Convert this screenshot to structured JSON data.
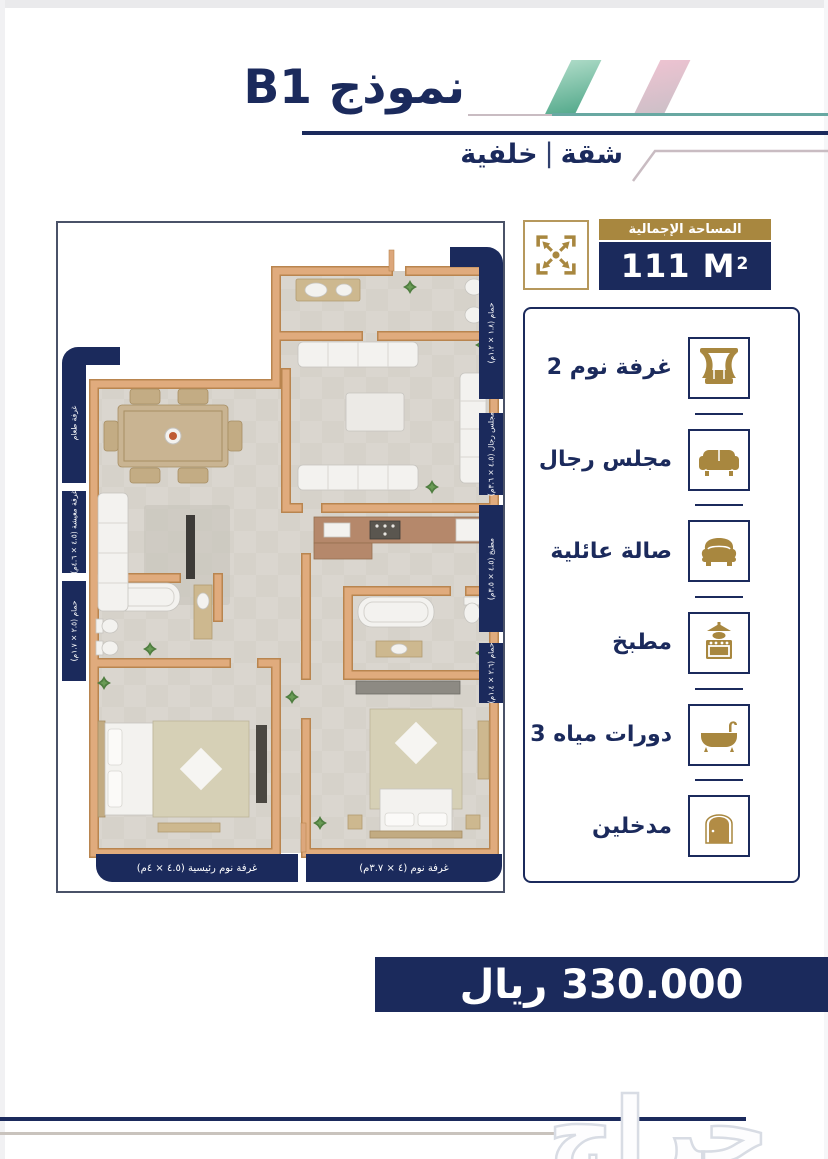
{
  "header": {
    "title": "نموذج B1",
    "subtitle_primary": "شقة",
    "subtitle_separator": "|",
    "subtitle_secondary": "خلفية"
  },
  "area": {
    "label": "المساحة الإجمالية",
    "value": "111 M",
    "superscript": "2",
    "icon": "expand-arrows-icon"
  },
  "floor_plan": {
    "labels_left": [
      {
        "text": "غرفة طعام"
      },
      {
        "text": "غرفة معيشة (٤.٥ × ٤.٦م)"
      },
      {
        "text": "حمام (٢.٥ × ١.٧م)"
      }
    ],
    "labels_right": [
      {
        "text": "حمام (١.٨ × ١.٢م)"
      },
      {
        "text": "مجلس رجال (٤.٥ × ٣.٦م)"
      },
      {
        "text": "مطبخ (٤.٥ × ٣.٥م)"
      },
      {
        "text": "حمام (٢.٦ × ١.٤م)"
      }
    ],
    "labels_bottom": [
      {
        "text": "غرفة نوم رئيسية (٤.٥ × ٤م)"
      },
      {
        "text": "غرفة نوم (٤ × ٣.٧م)"
      }
    ]
  },
  "legend": {
    "items": [
      {
        "label": "غرفة نوم 2",
        "icon": "bed-icon"
      },
      {
        "label": "مجلس رجال",
        "icon": "sofa-icon"
      },
      {
        "label": "صالة عائلية",
        "icon": "couch-icon"
      },
      {
        "label": "مطبخ",
        "icon": "stove-icon"
      },
      {
        "label": "دورات مياه 3",
        "icon": "bathtub-icon"
      },
      {
        "label": "مدخلين",
        "icon": "door-icon"
      }
    ]
  },
  "price": {
    "text": "330.000 ريال"
  },
  "watermark": {
    "text": "حراج"
  },
  "colors": {
    "navy": "#1b2a5c",
    "gold": "#a8873f",
    "teal": "#68a8a2",
    "pink": "#e4aec1",
    "wall": "#dfab7e"
  }
}
